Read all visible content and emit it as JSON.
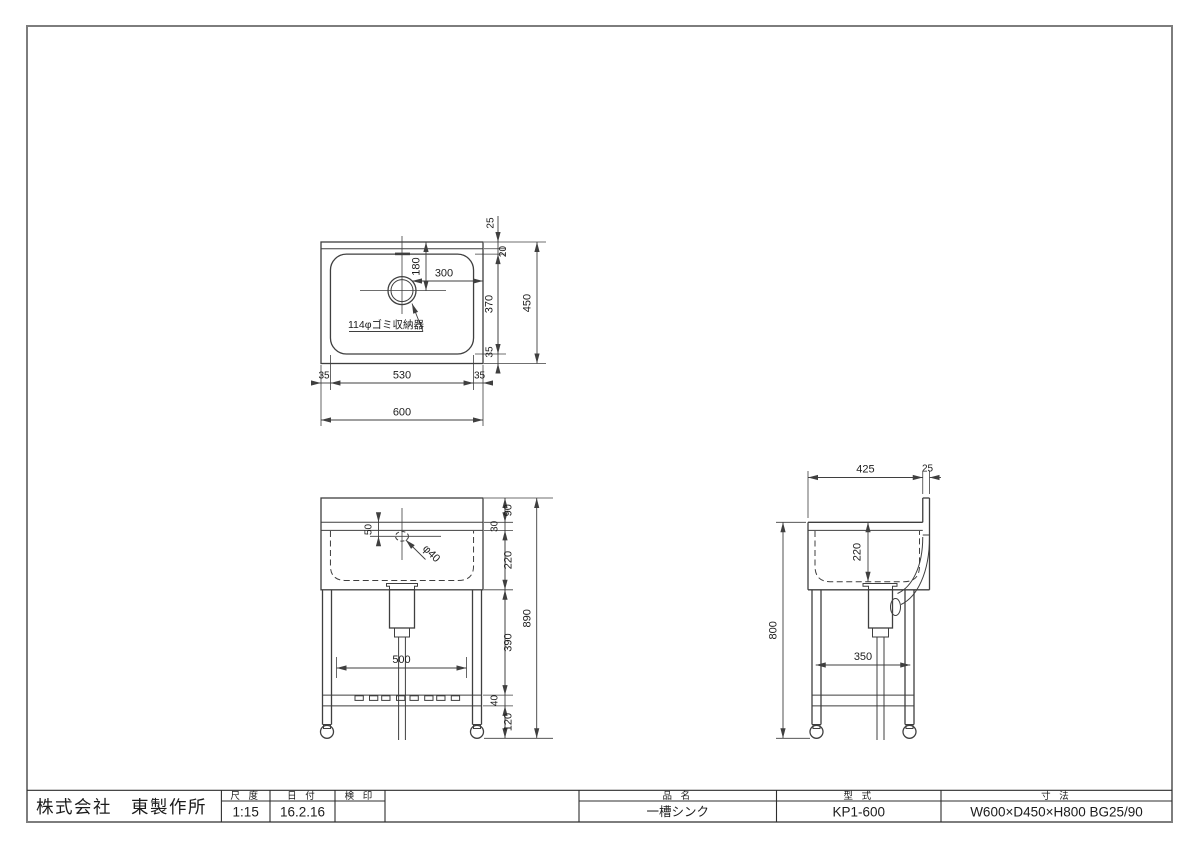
{
  "sheet": {
    "line_color": "#3f3f3f",
    "frame_color": "#7d7d7d",
    "background": "#ffffff"
  },
  "title_block": {
    "company": "株式会社　東製作所",
    "scale": {
      "label": "尺 度",
      "value": "1:15"
    },
    "date": {
      "label": "日 付",
      "value": "16.2.16"
    },
    "stamp": {
      "label": "検 印",
      "value": ""
    },
    "product": {
      "label": "品 名",
      "value": "一槽シンク"
    },
    "model": {
      "label": "型 式",
      "value": "KP1-600"
    },
    "size": {
      "label": "寸 法",
      "value": "W600×D450×H800 BG25/90"
    }
  },
  "top_view": {
    "note": "114φゴミ収納器",
    "dims": {
      "d25": "25",
      "d20": "20",
      "d180": "180",
      "d300": "300",
      "d370": "370",
      "d35_chain": "35",
      "d450": "450",
      "d35_left": "35",
      "d530": "530",
      "d35_right": "35",
      "d600": "600"
    }
  },
  "front_view": {
    "dims": {
      "d50": "50",
      "dphi40": "φ40",
      "d90": "90",
      "d30": "30",
      "d220": "220",
      "d390": "390",
      "d40": "40",
      "d120": "120",
      "d890": "890",
      "d500": "500"
    }
  },
  "side_view": {
    "dims": {
      "d425": "425",
      "d25": "25",
      "d220": "220",
      "d800": "800",
      "d350": "350"
    }
  }
}
